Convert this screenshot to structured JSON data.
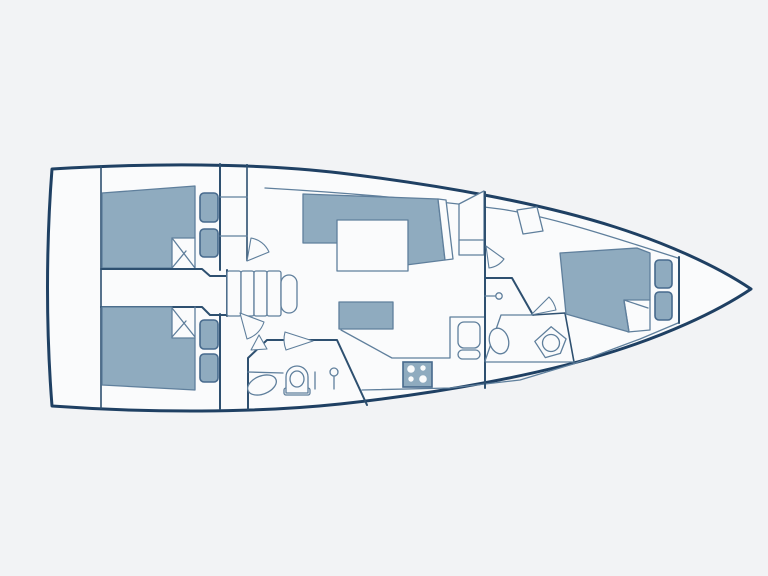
{
  "page": {
    "title": "Sailing yacht interior layout — deck plan, bow to the right",
    "kind": "boat-floor-plan"
  },
  "colors": {
    "background": "#f2f3f5",
    "paper": "#fafbfc",
    "hull": "#1f4063",
    "wall": "#2e5070",
    "line": "#5f7f9c",
    "furniture": "#8fabbf",
    "cushion_border": "#476a8d"
  },
  "boat": {
    "orientation": "bow-right",
    "areas": [
      {
        "id": "swim-platform",
        "label": "stern swim platform / transom",
        "furniture": []
      },
      {
        "id": "aft-cabin-port",
        "label": "aft cabin (port)",
        "furniture": [
          "double-berth",
          "folded-blanket-corner",
          "two-seat-cushions",
          "locker-unit",
          "door-swing"
        ]
      },
      {
        "id": "companionway",
        "label": "companionway passage",
        "furniture": [
          "steps"
        ],
        "step_count": 5
      },
      {
        "id": "aft-cabin-starboard",
        "label": "aft cabin (starboard)",
        "furniture": [
          "double-berth",
          "folded-blanket-corner",
          "two-seat-cushions",
          "door-swing"
        ]
      },
      {
        "id": "aft-head",
        "label": "aft head / wet room",
        "furniture": [
          "toilet",
          "washbasin-oval",
          "shower-mixer",
          "folding-door",
          "door-swing"
        ]
      },
      {
        "id": "salon",
        "label": "salon",
        "furniture": [
          "l-shaped-settee",
          "backrest",
          "dining-table",
          "bench-seat",
          "forward-cabinet",
          "side-deck-line"
        ]
      },
      {
        "id": "galley",
        "label": "galley",
        "furniture": [
          "counter",
          "stove-four-burner",
          "double-sink"
        ]
      },
      {
        "id": "forward-head",
        "label": "forward head",
        "furniture": [
          "toilet-angled",
          "washbasin-oval",
          "door-swing"
        ]
      },
      {
        "id": "forward-cabin",
        "label": "forward owner's cabin",
        "furniture": [
          "double-berth",
          "folded-blanket-corner",
          "two-seat-cushions",
          "hanging-locker",
          "compression-post",
          "door-swing"
        ]
      },
      {
        "id": "anchor-locker",
        "label": "anchor locker / bow",
        "furniture": []
      }
    ]
  }
}
